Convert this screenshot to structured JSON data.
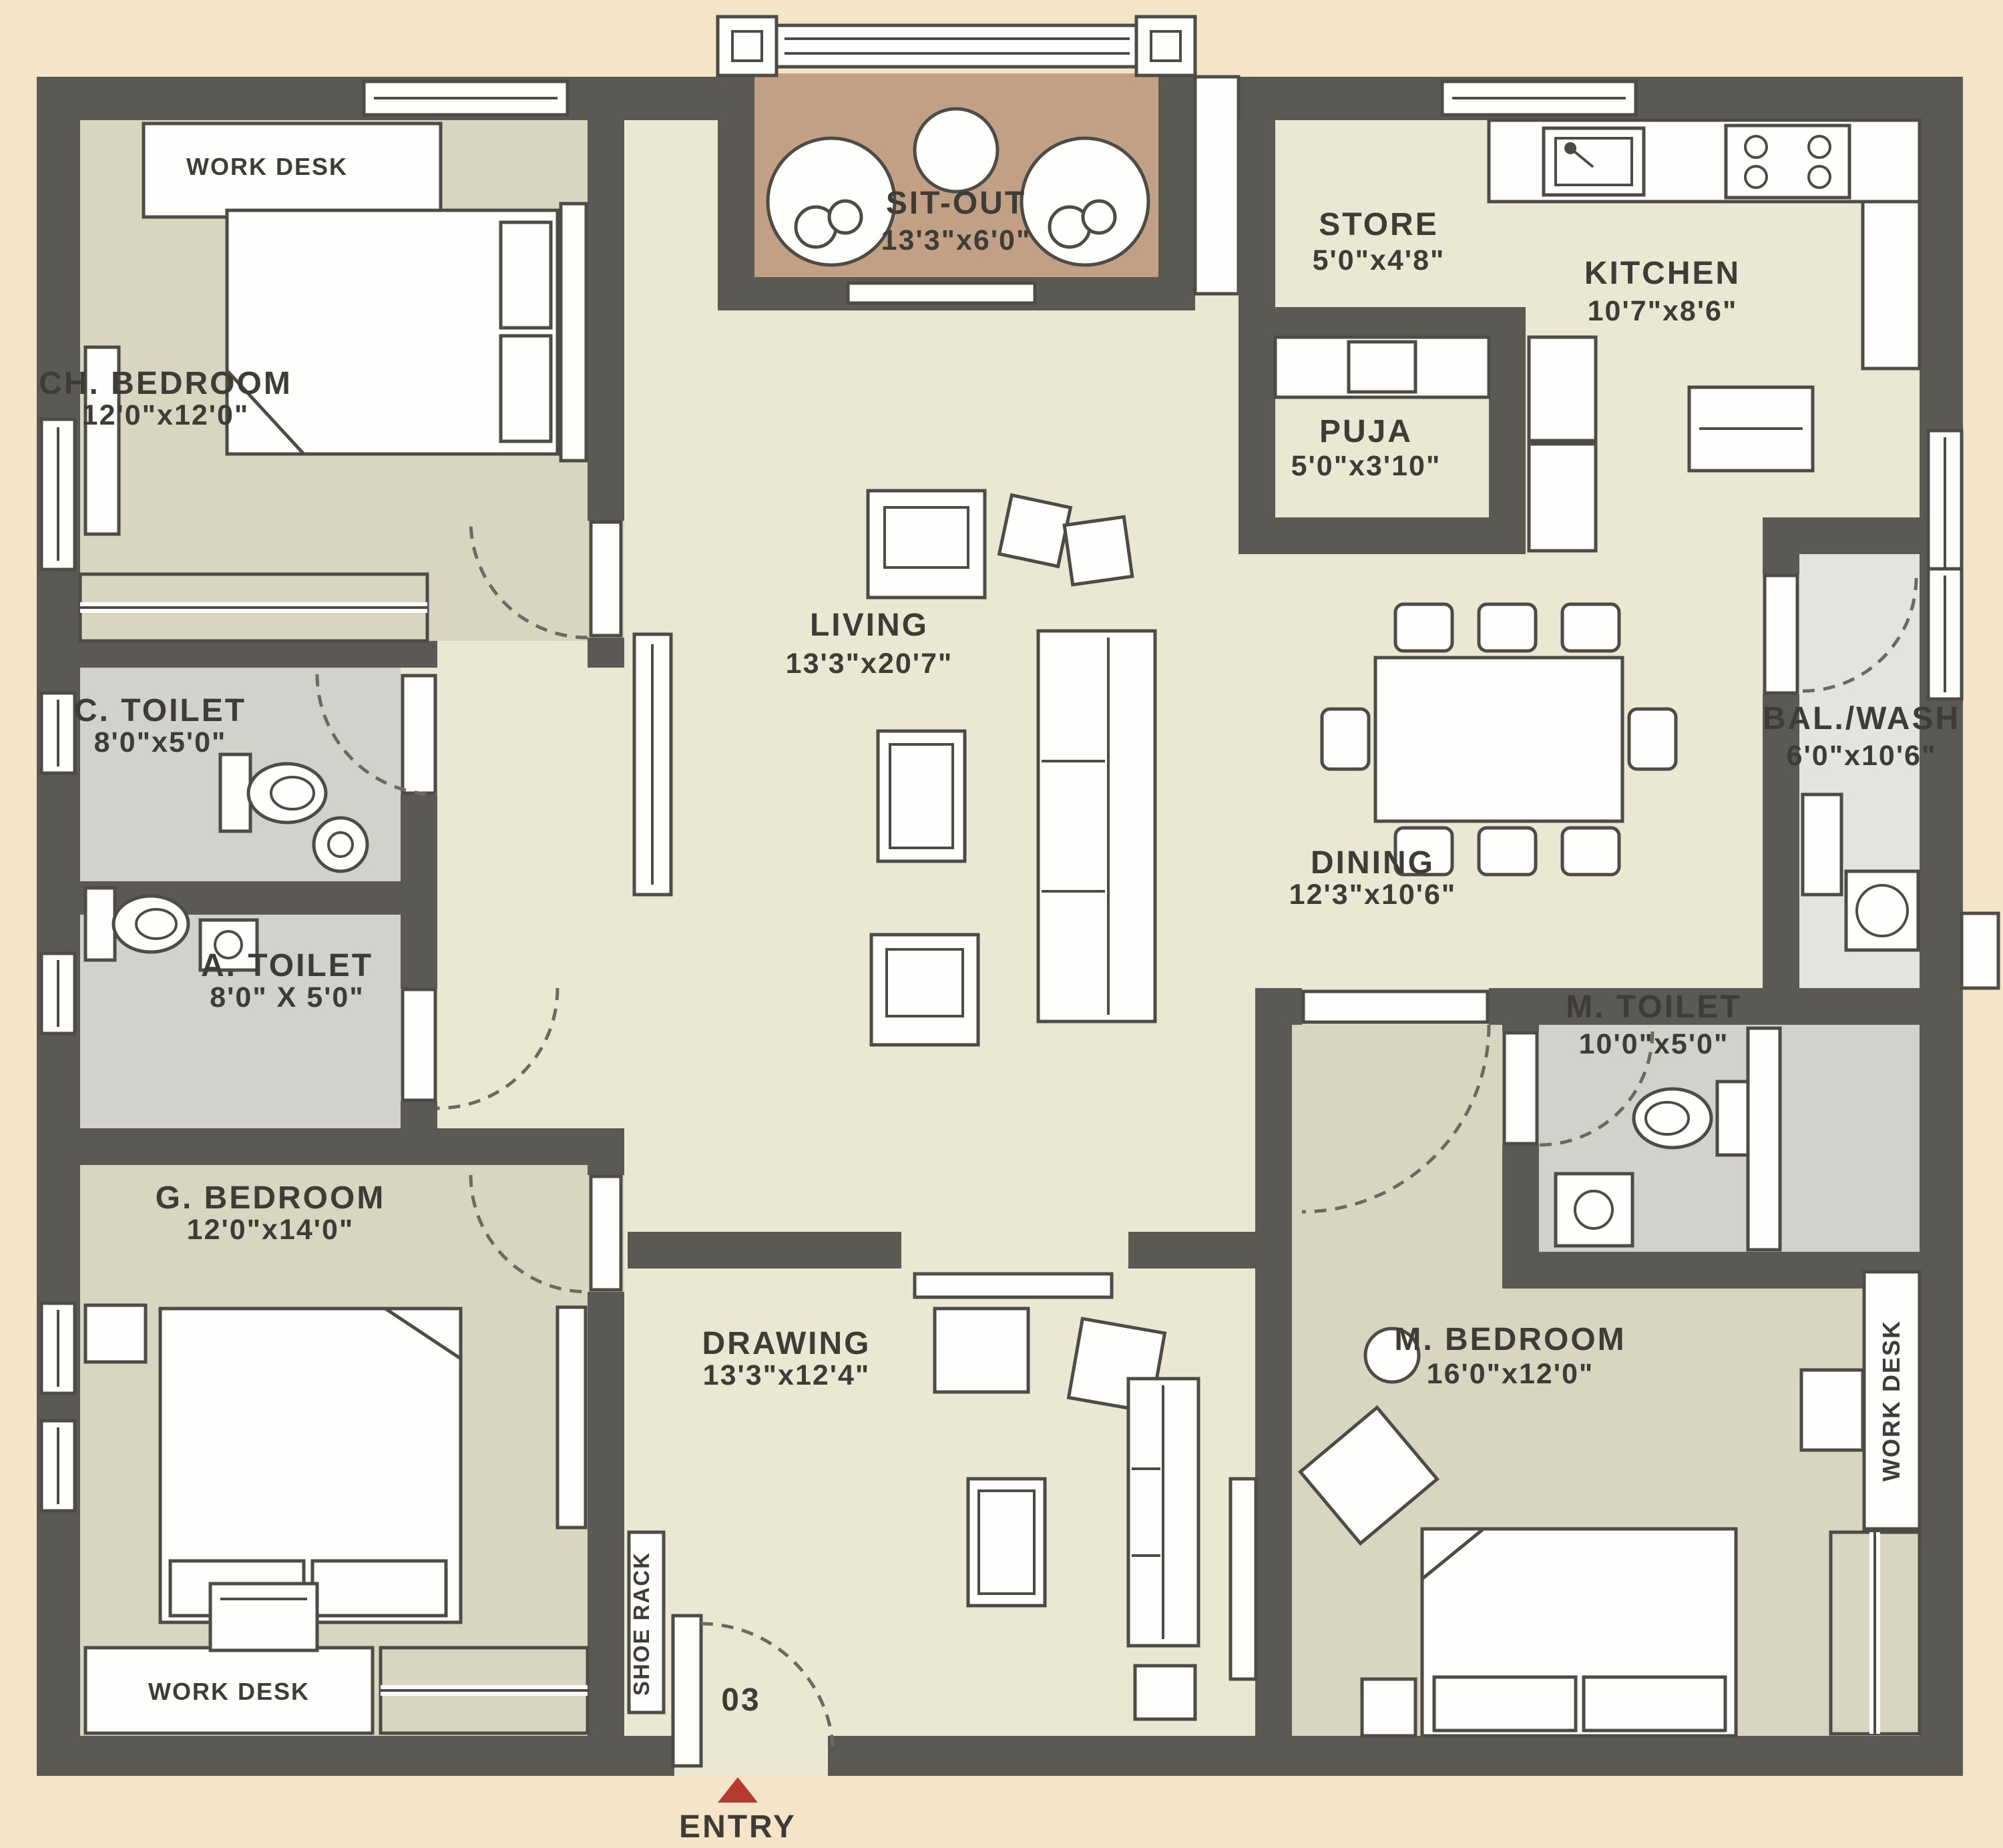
{
  "plan": {
    "rooms": [
      {
        "id": "ch-bedroom",
        "name": "CH. BEDROOM",
        "dims": "12'0\"x12'0\""
      },
      {
        "id": "c-toilet",
        "name": "C. TOILET",
        "dims": "8'0\"x5'0\""
      },
      {
        "id": "a-toilet",
        "name": "A. TOILET",
        "dims": "8'0\" X 5'0\""
      },
      {
        "id": "g-bedroom",
        "name": "G. BEDROOM",
        "dims": "12'0\"x14'0\""
      },
      {
        "id": "sit-out",
        "name": "SIT-OUT",
        "dims": "13'3\"x6'0\""
      },
      {
        "id": "living",
        "name": "LIVING",
        "dims": "13'3\"x20'7\""
      },
      {
        "id": "drawing",
        "name": "DRAWING",
        "dims": "13'3\"x12'4\""
      },
      {
        "id": "store",
        "name": "STORE",
        "dims": "5'0\"x4'8\""
      },
      {
        "id": "kitchen",
        "name": "KITCHEN",
        "dims": "10'7\"x8'6\""
      },
      {
        "id": "puja",
        "name": "PUJA",
        "dims": "5'0\"x3'10\""
      },
      {
        "id": "dining",
        "name": "DINING",
        "dims": "12'3\"x10'6\""
      },
      {
        "id": "bal-wash",
        "name": "BAL./WASH",
        "dims": "6'0\"x10'6\""
      },
      {
        "id": "m-toilet",
        "name": "M. TOILET",
        "dims": "10'0\"x5'0\""
      },
      {
        "id": "m-bedroom",
        "name": "M. BEDROOM",
        "dims": "16'0\"x12'0\""
      }
    ],
    "labels": {
      "work_desk": "WORK DESK",
      "shoe_rack": "SHOE RACK",
      "unit_number": "03",
      "entry": "ENTRY"
    },
    "colors": {
      "page_background": "#f4e5c8",
      "wall": "#5b5954",
      "open_floor": "#eae7d3",
      "bedroom_floor": "#d8d6c0",
      "toilet_floor": "#d2d2cc",
      "balcony_floor": "#e3e3df",
      "sitout_floor": "#c2a085",
      "furniture": "#fefefc",
      "text": "#3e3c36",
      "entry_arrow": "#b5392e"
    }
  }
}
